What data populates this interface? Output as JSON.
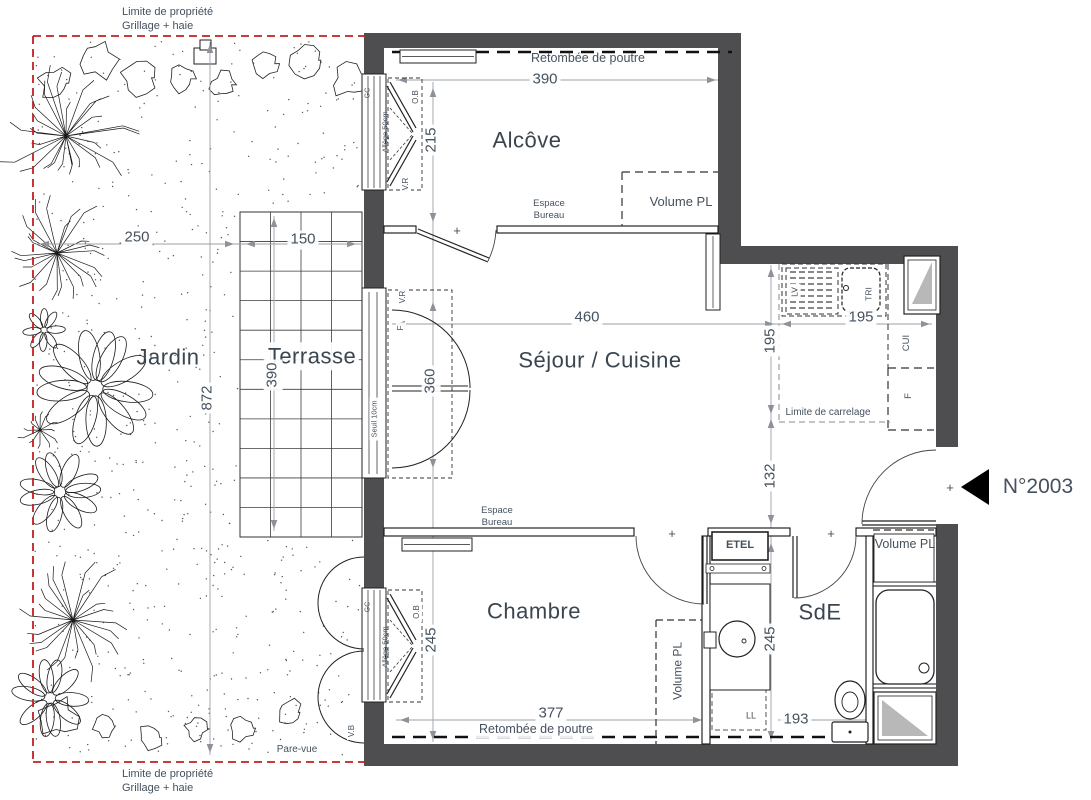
{
  "plan": {
    "unit_number": "N°2003",
    "rooms": [
      "Jardin",
      "Terrasse",
      "Alcôve",
      "Séjour / Cuisine",
      "Chambre",
      "SdE"
    ],
    "dimensions_cm": [
      "250",
      "150",
      "872",
      "390",
      "215",
      "390",
      "360",
      "460",
      "195",
      "195",
      "132",
      "245",
      "377",
      "245",
      "193"
    ],
    "colors": {
      "wall": "#4e4e50",
      "dim_line": "#9aa0a6",
      "text": "#45515e",
      "property_line": "#c02020",
      "window_triangle": "#b8b8b8"
    }
  },
  "texts": [
    {
      "id": "limite-propriete-haut",
      "t": "Limite de propriété\nGrillage + haie",
      "x": 122,
      "y": 6,
      "size": 11,
      "align": "left"
    },
    {
      "id": "retombee-poutre-haut",
      "t": "Retombée de poutre",
      "x": 588,
      "y": 59,
      "size": 12.5
    },
    {
      "id": "dim-390-alcove",
      "t": "390",
      "x": 545,
      "y": 80,
      "size": 15,
      "cls": "bg"
    },
    {
      "id": "room-alcove",
      "t": "Alcôve",
      "x": 527,
      "y": 140,
      "size": 22,
      "cls": "room"
    },
    {
      "id": "dim-215",
      "t": "215",
      "x": 432,
      "y": 140,
      "size": 15,
      "rot": 1,
      "cls": "bg"
    },
    {
      "id": "label-ob-alcove",
      "t": "O.B",
      "x": 416,
      "y": 97,
      "size": 8,
      "rot": 1,
      "cls": "bg"
    },
    {
      "id": "label-allege-alcove",
      "t": "Allège 50cm",
      "x": 385,
      "y": 132,
      "size": 7.5,
      "rot": 1
    },
    {
      "id": "label-gc-alcove",
      "t": "GC",
      "x": 369,
      "y": 93,
      "size": 7,
      "rot": 1
    },
    {
      "id": "label-vr-alcove",
      "t": "V.R",
      "x": 406,
      "y": 184,
      "size": 8,
      "rot": 1,
      "cls": "bg"
    },
    {
      "id": "label-espace-bureau-alcove",
      "t": "Espace\nBureau",
      "x": 549,
      "y": 210,
      "size": 9.5
    },
    {
      "id": "label-volume-pl-alcove",
      "t": "Volume PL",
      "x": 681,
      "y": 202,
      "size": 13
    },
    {
      "id": "plus-porte-alcove",
      "t": "+",
      "x": 457,
      "y": 231,
      "size": 13
    },
    {
      "id": "dim-250",
      "t": "250",
      "x": 137,
      "y": 238,
      "size": 15,
      "cls": "bg"
    },
    {
      "id": "dim-150",
      "t": "150",
      "x": 303,
      "y": 240,
      "size": 15,
      "cls": "bg"
    },
    {
      "id": "room-jardin",
      "t": "Jardin",
      "x": 168,
      "y": 357,
      "size": 22,
      "cls": "room"
    },
    {
      "id": "room-terrasse",
      "t": "Terrasse",
      "x": 312,
      "y": 356,
      "size": 22,
      "cls": "room bg"
    },
    {
      "id": "dim-872",
      "t": "872",
      "x": 208,
      "y": 398,
      "size": 15,
      "rot": 1,
      "cls": "bg"
    },
    {
      "id": "dim-390-terrasse",
      "t": "390",
      "x": 273,
      "y": 375,
      "size": 15,
      "rot": 1,
      "cls": "bg"
    },
    {
      "id": "label-seuil",
      "t": "Seuil 10cm",
      "x": 374,
      "y": 419,
      "size": 7.5,
      "rot": 1,
      "cls": "bg"
    },
    {
      "id": "label-vr-sejour",
      "t": "V.R",
      "x": 403,
      "y": 297,
      "size": 8,
      "rot": 1,
      "cls": "bg"
    },
    {
      "id": "label-f-sejour",
      "t": "F",
      "x": 401,
      "y": 328,
      "size": 8,
      "rot": 1,
      "cls": "bg"
    },
    {
      "id": "dim-360",
      "t": "360",
      "x": 431,
      "y": 381,
      "size": 15,
      "rot": 1,
      "cls": "bg"
    },
    {
      "id": "room-sejour",
      "t": "Séjour / Cuisine",
      "x": 600,
      "y": 360,
      "size": 22,
      "cls": "room"
    },
    {
      "id": "dim-460",
      "t": "460",
      "x": 587,
      "y": 318,
      "size": 15,
      "cls": "bg"
    },
    {
      "id": "dim-195-h",
      "t": "195",
      "x": 861,
      "y": 318,
      "size": 15,
      "cls": "bg"
    },
    {
      "id": "dim-195-v",
      "t": "195",
      "x": 771,
      "y": 341,
      "size": 15,
      "rot": 1,
      "cls": "bg"
    },
    {
      "id": "label-lv",
      "t": "LV",
      "x": 795,
      "y": 292,
      "size": 8.5,
      "rot": 1,
      "cls": "bg"
    },
    {
      "id": "label-tri",
      "t": "TRI",
      "x": 869,
      "y": 294,
      "size": 8.5,
      "rot": 1,
      "cls": "bg"
    },
    {
      "id": "label-cui",
      "t": "CUI",
      "x": 907,
      "y": 343,
      "size": 9.5,
      "rot": 1
    },
    {
      "id": "label-f-cuisine",
      "t": "F",
      "x": 909,
      "y": 396,
      "size": 9.5,
      "rot": 1
    },
    {
      "id": "label-limite-carrelage",
      "t": "Limite de carrelage",
      "x": 828,
      "y": 413,
      "size": 10,
      "cls": "bg"
    },
    {
      "id": "dim-132",
      "t": "132",
      "x": 771,
      "y": 476,
      "size": 15,
      "rot": 1,
      "cls": "bg"
    },
    {
      "id": "plus-entree",
      "t": "+",
      "x": 950,
      "y": 488,
      "size": 13
    },
    {
      "id": "label-numero",
      "t": "N°2003",
      "x": 1038,
      "y": 487,
      "size": 21
    },
    {
      "id": "label-espace-bureau-chambre",
      "t": "Espace\nBureau",
      "x": 497,
      "y": 517,
      "size": 9.5
    },
    {
      "id": "plus-porte-chambre",
      "t": "+",
      "x": 672,
      "y": 534,
      "size": 13
    },
    {
      "id": "plus-porte-sde",
      "t": "+",
      "x": 831,
      "y": 534,
      "size": 13
    },
    {
      "id": "label-etel",
      "t": "ETEL",
      "x": 740,
      "y": 546,
      "size": 11,
      "cls": "bold"
    },
    {
      "id": "label-volume-pl-sde",
      "t": "Volume PL",
      "x": 905,
      "y": 545,
      "size": 12.5
    },
    {
      "id": "room-chambre",
      "t": "Chambre",
      "x": 534,
      "y": 611,
      "size": 22,
      "cls": "room"
    },
    {
      "id": "room-sde",
      "t": "SdE",
      "x": 820,
      "y": 612,
      "size": 22,
      "cls": "room"
    },
    {
      "id": "label-ob-chambre",
      "t": "O.B",
      "x": 417,
      "y": 612,
      "size": 8,
      "rot": 1,
      "cls": "bg"
    },
    {
      "id": "label-allege-chambre",
      "t": "Allège 50cm",
      "x": 385,
      "y": 647,
      "size": 7.5,
      "rot": 1
    },
    {
      "id": "label-gc-chambre",
      "t": "GC",
      "x": 369,
      "y": 607,
      "size": 7,
      "rot": 1
    },
    {
      "id": "dim-245-chambre",
      "t": "245",
      "x": 432,
      "y": 640,
      "size": 15,
      "rot": 1,
      "cls": "bg"
    },
    {
      "id": "label-volume-pl-chambre",
      "t": "Volume PL",
      "x": 678,
      "y": 671,
      "size": 12,
      "rot": 1,
      "cls": "bg"
    },
    {
      "id": "dim-245-sde",
      "t": "245",
      "x": 771,
      "y": 639,
      "size": 15,
      "rot": 1,
      "cls": "bg"
    },
    {
      "id": "label-ll",
      "t": "LL",
      "x": 751,
      "y": 716,
      "size": 9,
      "cls": "bg"
    },
    {
      "id": "dim-377",
      "t": "377",
      "x": 551,
      "y": 714,
      "size": 15,
      "cls": "bg"
    },
    {
      "id": "dim-193",
      "t": "193",
      "x": 796,
      "y": 720,
      "size": 15,
      "cls": "bg"
    },
    {
      "id": "retombee-poutre-bas",
      "t": "Retombée de poutre",
      "x": 536,
      "y": 730,
      "size": 12.5,
      "cls": "bg"
    },
    {
      "id": "label-vb",
      "t": "V.B",
      "x": 352,
      "y": 731,
      "size": 8,
      "rot": 1,
      "cls": "bg"
    },
    {
      "id": "label-pare-vue",
      "t": "Pare-vue",
      "x": 297,
      "y": 750,
      "size": 10
    },
    {
      "id": "limite-propriete-bas",
      "t": "Limite de propriété\nGrillage + haie",
      "x": 122,
      "y": 768,
      "size": 11,
      "align": "left"
    }
  ]
}
